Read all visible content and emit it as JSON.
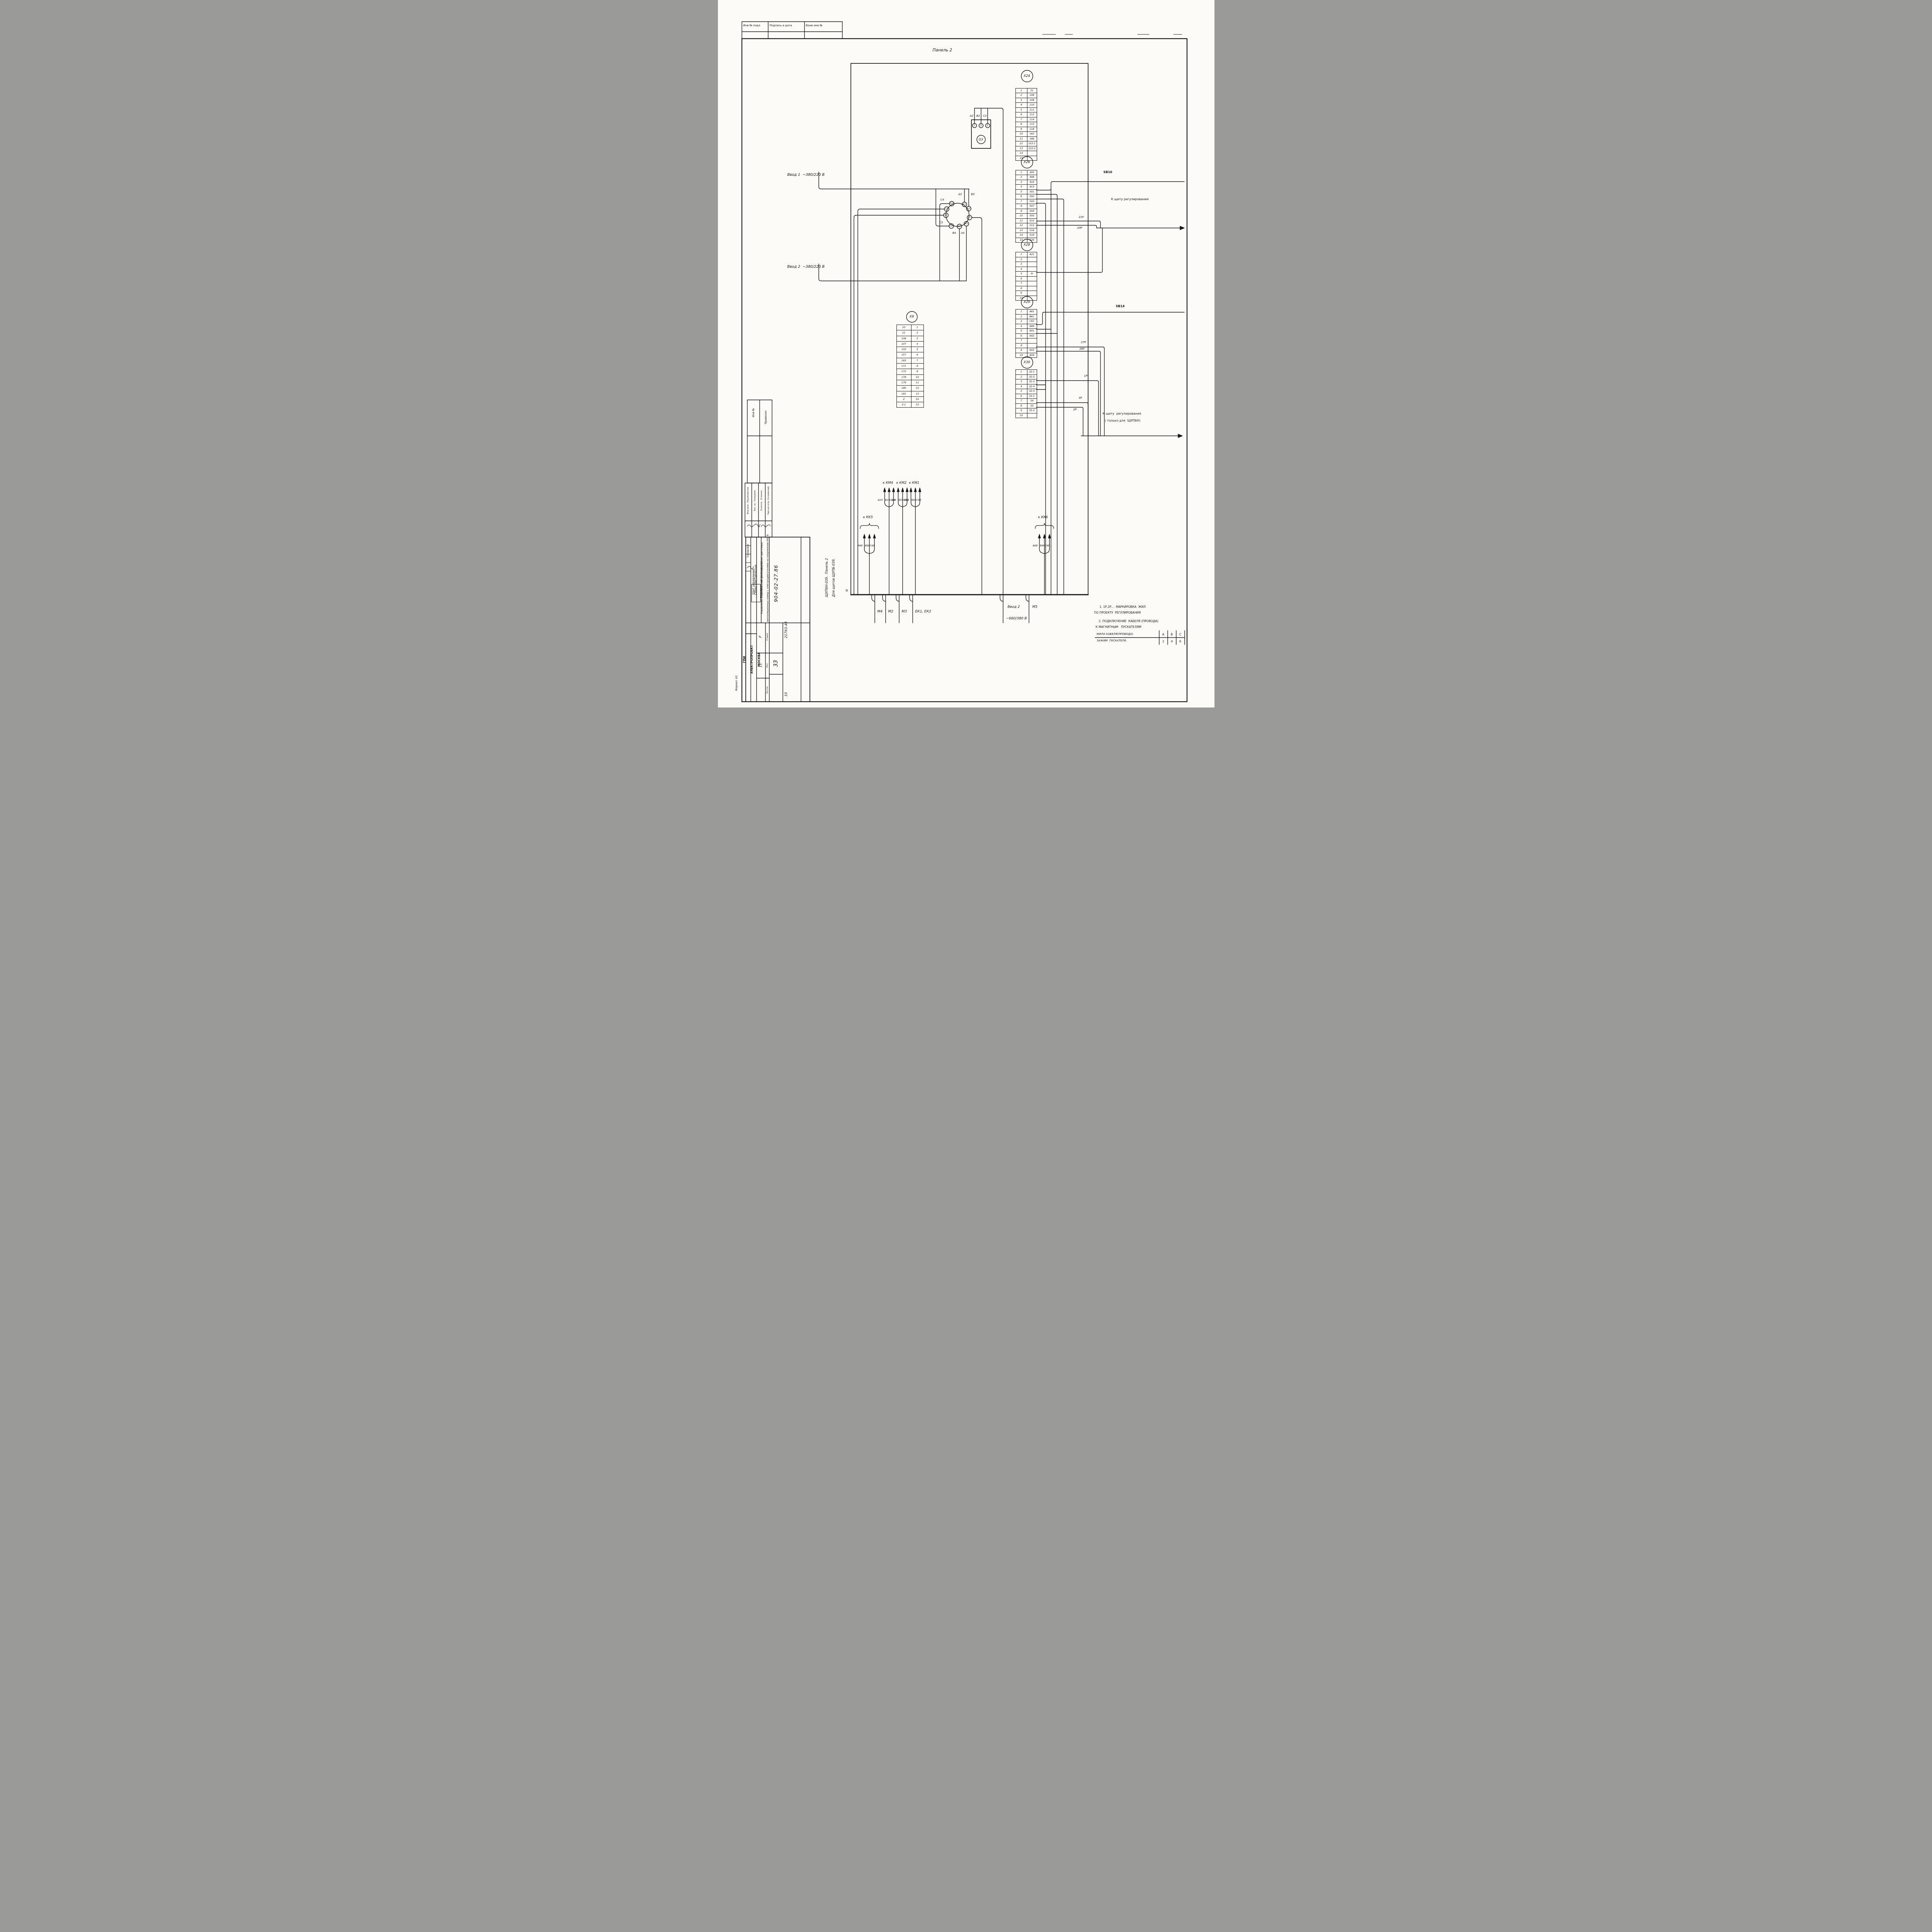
{
  "sheet": {
    "top_stamp": {
      "c1": "Инв № подл",
      "c2": "Подпись и дата",
      "c3": "Взам инв №"
    },
    "panel_title": "Панель 2",
    "n_mark": "N",
    "side_note": {
      "line1": "Для щитов ЩУПБ-039,",
      "line2": "ЩУП6Н-039.  Панель 2"
    },
    "format_note": "Формат А2",
    "copied_by": "Копировал"
  },
  "feeders": {
    "vvod1": "Ввод 1  ~380/220 В",
    "vvod2": "Ввод 2  ~380/220 В",
    "vvod2_bottom_1": "Ввод 2",
    "vvod2_bottom_2": "~660/380 В"
  },
  "breaker": {
    "name": "Q3",
    "t1": "1",
    "t2": "3",
    "t3": "5",
    "w1": "А2",
    "w2": "В2",
    "w3": "С2"
  },
  "selector": {
    "t_2l3": "2L3",
    "t_1l1": "1L1",
    "t_c2": "С2",
    "t_1l2": "1L2",
    "t_c1": "С1",
    "t_c3": "С3",
    "t_1l3": "1L3",
    "t_2l2": "2L2",
    "t_2l1": "2L1",
    "w_c4": "С4",
    "w_a3": "А3",
    "w_b3": "В3",
    "w_c3": "С3",
    "w_b4": "В4",
    "w_a4": "А4"
  },
  "connectors": {
    "x9": {
      "id": "X9",
      "pins": [
        [
          "10",
          "1"
        ],
        [
          "21",
          "2"
        ],
        [
          "106",
          "3"
        ],
        [
          "107",
          "4"
        ],
        [
          "155",
          "5"
        ],
        [
          "157",
          "6"
        ],
        [
          "165",
          "7"
        ],
        [
          "171",
          "8"
        ],
        [
          "172",
          "9"
        ],
        [
          "178",
          "10"
        ],
        [
          "179",
          "11"
        ],
        [
          "180",
          "12"
        ],
        [
          "181",
          "13"
        ],
        [
          "2",
          "14"
        ],
        [
          "3-1",
          "15"
        ]
      ]
    },
    "x24": {
      "id": "X24",
      "pins": [
        [
          "1",
          "31"
        ],
        [
          "2",
          "108"
        ],
        [
          "3",
          "109"
        ],
        [
          "4",
          "110"
        ],
        [
          "5",
          "111"
        ],
        [
          "6",
          "112"
        ],
        [
          "7",
          "114"
        ],
        [
          "8",
          "115"
        ],
        [
          "9",
          "118"
        ],
        [
          "10",
          "163"
        ],
        [
          "11",
          "166"
        ],
        [
          "12",
          "122-1"
        ],
        [
          "13",
          "122-2"
        ],
        [
          "14",
          ""
        ],
        [
          "15",
          ""
        ]
      ]
    },
    "x26": {
      "id": "X26",
      "pins": [
        [
          "1",
          "405"
        ],
        [
          "2",
          "406"
        ],
        [
          "3",
          "410"
        ],
        [
          "4",
          "413"
        ],
        [
          "5",
          "501"
        ],
        [
          "6",
          "502"
        ],
        [
          "7",
          "503"
        ],
        [
          "8",
          "507"
        ],
        [
          "9",
          "504"
        ],
        [
          "10",
          "505"
        ],
        [
          "11",
          "510"
        ],
        [
          "12",
          "513"
        ],
        [
          "13",
          "516"
        ],
        [
          "14",
          "518"
        ],
        [
          "15",
          "520"
        ]
      ]
    },
    "x28": {
      "id": "X28",
      "pins": [
        [
          "1",
          "А21"
        ],
        [
          "2",
          ""
        ],
        [
          "3",
          ""
        ],
        [
          "4",
          ""
        ],
        [
          "5",
          "N"
        ],
        [
          "6",
          ""
        ],
        [
          "7",
          ""
        ],
        [
          "8",
          ""
        ],
        [
          "9",
          ""
        ],
        [
          "10",
          ""
        ]
      ]
    },
    "x29": {
      "id": "X29",
      "pins": [
        [
          "1",
          "А61"
        ],
        [
          "2",
          "В61"
        ],
        [
          "3",
          "С61"
        ],
        [
          "4",
          "А66"
        ],
        [
          "5",
          "601"
        ],
        [
          "6",
          "602"
        ],
        [
          "7",
          ""
        ],
        [
          "8",
          ""
        ],
        [
          "9",
          "603"
        ],
        [
          "10",
          "604"
        ]
      ]
    },
    "x30": {
      "id": "X30",
      "pins": [
        [
          "1",
          "32-1"
        ],
        [
          "2",
          "32-2"
        ],
        [
          "3",
          "32-3"
        ],
        [
          "4",
          "32-4"
        ],
        [
          "5",
          "32-5"
        ],
        [
          "6",
          "33-1"
        ],
        [
          "7",
          "34"
        ],
        [
          "8",
          "35"
        ],
        [
          "9",
          "35-2"
        ],
        [
          "10",
          ""
        ]
      ]
    }
  },
  "wire_tags": {
    "t21p": "21Р",
    "t20p": "20Р",
    "t27p": "27Р",
    "t26p": "26Р",
    "t1p": "1Р",
    "t3p": "3Р",
    "t2p": "2Р"
  },
  "destinations": {
    "sb10": "SB10",
    "sb14": "SB14",
    "reg1": "К щиту регулирования",
    "reg2a": "К щиту  регулирования",
    "reg2b": "( только для  ЩУП6Н)"
  },
  "cable_groups": {
    "km4": {
      "label": "к КМ4",
      "a": "А24",
      "b": "В24",
      "c": "С24"
    },
    "km2": {
      "label": "к КМ2",
      "a": "А54",
      "b": "В54",
      "c": "С54"
    },
    "km1": {
      "label": "к КМ1",
      "a": "А63",
      "b": "В63",
      "c": "С63"
    },
    "kk5": {
      "label": "к КК5",
      "a": "А68",
      "b": "В68",
      "c": "С68"
    },
    "kk6": {
      "label": "к КК6",
      "a": "А69",
      "b": "В69",
      "c": "С69"
    }
  },
  "bottom": {
    "m4": "М4",
    "m2": "М2",
    "m3": "М3",
    "ek": "ЕК1, ЕК2",
    "m5": "М5"
  },
  "notes": {
    "n1a": "1. 1Р,2Р...  МАРКИРОВКА  ЖИЛ",
    "n1b": "ПО ПРОЕКТУ  РЕГУЛИРОВАНИЯ",
    "n2a": "2. ПОДКЛЮЧЕНИЕ  КАБЕЛЯ (ПРОВОДА)",
    "n2b": "К МАГНИТНЫМ   ПУСКАТЕЛЯМ"
  },
  "pu_table": {
    "r1c0": "ЖИЛА КАБЕЛЯ(ПРОВОДА)",
    "r1c1": "А",
    "r1c2": "В",
    "r1c3": "С",
    "r2c0": "ЗАЖИМ  ПУСКАТЕЛЯ.",
    "r2c1": "2",
    "r2c2": "4",
    "r2c3": "6"
  },
  "title_block": {
    "doc_number": "904-02-27.86",
    "sheet_big": "33",
    "org1": "ГПИ",
    "org2": "ЭЛЕКТРОПРОЕКТ",
    "org3": "МОСКВА",
    "stage_label": "Стадия",
    "stage": "Р",
    "list_label": "Лист",
    "list": "15",
    "listov_label": "Листов",
    "title_small1": "Щит управления",
    "title_small2": "Схема электрическая",
    "title_small3": "подключений (окончание)",
    "project1": "Управление и силовое электрооборудование приточных",
    "project2": "вентиляционных камер с электродвигателями на напряжение 660 В",
    "inv_hand": "21763-49",
    "sheet_hand": "10",
    "roles": [
      {
        "role": "Зам.нач.отд",
        "name": "Островский"
      },
      {
        "role": "Н.контр.",
        "name": "Огиенко"
      },
      {
        "role": "Рук. гр.",
        "name": "Гинодман"
      },
      {
        "role": "Вед.инж.",
        "name": "Кишиневская"
      }
    ],
    "inv_col1": "Инв №",
    "inv_col2": "Привязан"
  }
}
